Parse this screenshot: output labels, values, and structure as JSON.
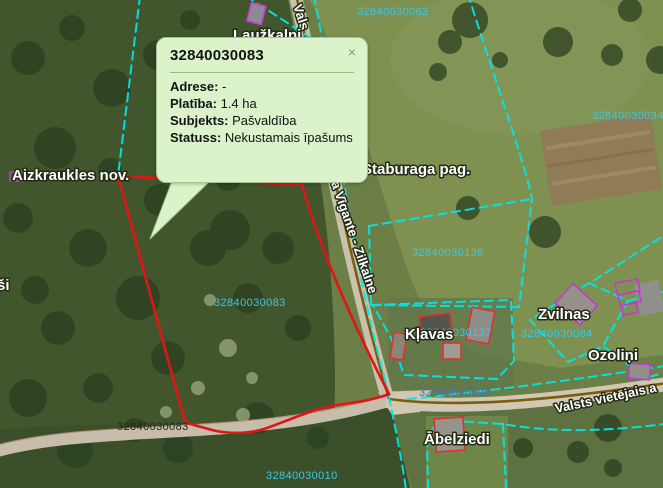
{
  "popup": {
    "title": "32840030083",
    "close_label": "×",
    "rows": [
      {
        "label": "Adrese:",
        "value": "-"
      },
      {
        "label": "Platība:",
        "value": "1.4 ha"
      },
      {
        "label": "Subjekts:",
        "value": "Pašvaldība"
      },
      {
        "label": "Statuss:",
        "value": "Nekustamais īpašums"
      }
    ]
  },
  "labels": {
    "admin_region": "Aizkraukles nov.",
    "admin_parish": "Staburaga pag.",
    "place_lauzkalni": "Laužkalni",
    "place_klavas": "Kļavas",
    "place_zvilnas": "Zvilnas",
    "place_ozolini": "Ozoliņi",
    "place_abelziedi": "Ābelziedi",
    "place_partial": "ši",
    "road_top": "Vals",
    "road_vigante": "a Vīgante - Zilkalne",
    "road_valsts": "Valsts vietējais a"
  },
  "parcels": {
    "p062": "32840030062",
    "p034": "32840030034",
    "p136": "32840030136",
    "p083": "32840030083",
    "p084": "32840030084",
    "p137": "32840030137",
    "p099": "32840030099",
    "p010": "32840030010",
    "p083_road": "32840030083"
  },
  "colors": {
    "parcel_line": "#00e6e6",
    "selected_parcel": "#e51414",
    "building": "#c23ad2",
    "selected_building": "#e03030",
    "road_centerline": "#7d5c0e",
    "parcel_number": "#38c9e8",
    "parcel_number_blue": "#3f6fc6",
    "parcel_number_dark": "#232718",
    "popup_background": "#dcf2ca"
  }
}
